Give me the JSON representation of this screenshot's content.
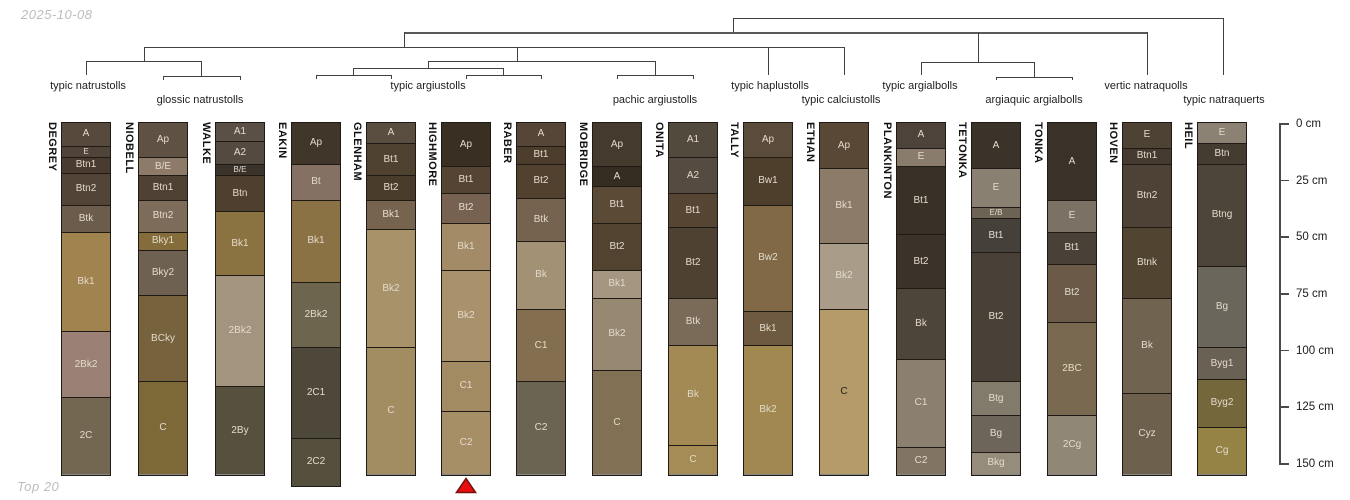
{
  "header": {
    "date_label": "2025-10-08"
  },
  "footer": {
    "label": "Top 20"
  },
  "style_colors": {
    "marker_fill": "#e90f0f",
    "marker_stroke": "#7a1010",
    "dendrogram_line": "#414141",
    "column_border": "#1f1a14"
  },
  "chart_data": {
    "type": "soil-profile-dendrogram",
    "depth_axis": {
      "unit": "cm",
      "tick_labels": [
        "0 cm",
        "25 cm",
        "50 cm",
        "75 cm",
        "100 cm",
        "125 cm",
        "150 cm"
      ],
      "tick_values": [
        0,
        25,
        50,
        75,
        100,
        125,
        150
      ]
    },
    "cluster_labels": [
      {
        "label": "typic natrustolls",
        "x": 88,
        "row": 1
      },
      {
        "label": "glossic natrustolls",
        "x": 200,
        "row": 2
      },
      {
        "label": "typic argiustolls",
        "x": 428,
        "row": 1
      },
      {
        "label": "pachic argiustolls",
        "x": 655,
        "row": 2
      },
      {
        "label": "typic haplustolls",
        "x": 770,
        "row": 1
      },
      {
        "label": "typic calciustolls",
        "x": 841,
        "row": 2
      },
      {
        "label": "typic argialbolls",
        "x": 920,
        "row": 1
      },
      {
        "label": "argiaquic argialbolls",
        "x": 1034,
        "row": 2
      },
      {
        "label": "vertic natraquolls",
        "x": 1146,
        "row": 1
      },
      {
        "label": "typic natraquerts",
        "x": 1224,
        "row": 2
      }
    ],
    "profiles": [
      {
        "name": "DEGREY",
        "cx": 86,
        "marker": false,
        "horizons": [
          {
            "label": "A",
            "top": 0,
            "bottom": 10,
            "color": "#57493c"
          },
          {
            "label": "E",
            "top": 10,
            "bottom": 15,
            "color": "#4f433a"
          },
          {
            "label": "Btn1",
            "top": 15,
            "bottom": 22,
            "color": "#493b2f"
          },
          {
            "label": "Btn2",
            "top": 22,
            "bottom": 36,
            "color": "#524437"
          },
          {
            "label": "Btk",
            "top": 36,
            "bottom": 48,
            "color": "#6c5c4b"
          },
          {
            "label": "Bk1",
            "top": 48,
            "bottom": 92,
            "color": "#a0834e"
          },
          {
            "label": "2Bk2",
            "top": 92,
            "bottom": 121,
            "color": "#9b8175"
          },
          {
            "label": "2C",
            "top": 121,
            "bottom": 155,
            "color": "#746751"
          }
        ]
      },
      {
        "name": "NIOBELL",
        "cx": 163,
        "marker": false,
        "horizons": [
          {
            "label": "Ap",
            "top": 0,
            "bottom": 15,
            "color": "#5f5143"
          },
          {
            "label": "B/E",
            "top": 15,
            "bottom": 23,
            "color": "#8d7a69"
          },
          {
            "label": "Btn1",
            "top": 23,
            "bottom": 34,
            "color": "#4f4134"
          },
          {
            "label": "Btn2",
            "top": 34,
            "bottom": 48,
            "color": "#7e6c5b"
          },
          {
            "label": "Bky1",
            "top": 48,
            "bottom": 56,
            "color": "#856d3b"
          },
          {
            "label": "Bky2",
            "top": 56,
            "bottom": 76,
            "color": "#6e6152"
          },
          {
            "label": "BCky",
            "top": 76,
            "bottom": 114,
            "color": "#76623c"
          },
          {
            "label": "C",
            "top": 114,
            "bottom": 155,
            "color": "#7d6838"
          }
        ]
      },
      {
        "name": "WALKE",
        "cx": 240,
        "marker": false,
        "horizons": [
          {
            "label": "A1",
            "top": 0,
            "bottom": 8,
            "color": "#5a5045"
          },
          {
            "label": "A2",
            "top": 8,
            "bottom": 18,
            "color": "#554a3f"
          },
          {
            "label": "B/E",
            "top": 18,
            "bottom": 23,
            "color": "#3a332b"
          },
          {
            "label": "Btn",
            "top": 23,
            "bottom": 39,
            "color": "#4e3f2e"
          },
          {
            "label": "Bk1",
            "top": 39,
            "bottom": 67,
            "color": "#8a7340"
          },
          {
            "label": "2Bk2",
            "top": 67,
            "bottom": 116,
            "color": "#a39480"
          },
          {
            "label": "2By",
            "top": 116,
            "bottom": 155,
            "color": "#56503f"
          }
        ]
      },
      {
        "name": "EAKIN",
        "cx": 316,
        "marker": false,
        "horizons": [
          {
            "label": "Ap",
            "top": 0,
            "bottom": 18,
            "color": "#41362a"
          },
          {
            "label": "Bt",
            "top": 18,
            "bottom": 34,
            "color": "#857163"
          },
          {
            "label": "Bk1",
            "top": 34,
            "bottom": 70,
            "color": "#8b7244"
          },
          {
            "label": "2Bk2",
            "top": 70,
            "bottom": 99,
            "color": "#6e654f"
          },
          {
            "label": "2C1",
            "top": 99,
            "bottom": 139,
            "color": "#4d483a"
          },
          {
            "label": "2C2",
            "top": 139,
            "bottom": 160,
            "color": "#55503e"
          }
        ]
      },
      {
        "name": "GLENHAM",
        "cx": 391,
        "marker": false,
        "horizons": [
          {
            "label": "A",
            "top": 0,
            "bottom": 9,
            "color": "#5a4e41"
          },
          {
            "label": "Bt1",
            "top": 9,
            "bottom": 23,
            "color": "#504231"
          },
          {
            "label": "Bt2",
            "top": 23,
            "bottom": 34,
            "color": "#4a3c2b"
          },
          {
            "label": "Bk1",
            "top": 34,
            "bottom": 47,
            "color": "#76644e"
          },
          {
            "label": "Bk2",
            "top": 47,
            "bottom": 99,
            "color": "#a8926a"
          },
          {
            "label": "C",
            "top": 99,
            "bottom": 155,
            "color": "#a28c62"
          }
        ]
      },
      {
        "name": "HIGHMORE",
        "cx": 466,
        "marker": true,
        "horizons": [
          {
            "label": "Ap",
            "top": 0,
            "bottom": 19,
            "color": "#392f23"
          },
          {
            "label": "Bt1",
            "top": 19,
            "bottom": 31,
            "color": "#554434"
          },
          {
            "label": "Bt2",
            "top": 31,
            "bottom": 44,
            "color": "#776150"
          },
          {
            "label": "Bk1",
            "top": 44,
            "bottom": 65,
            "color": "#a28b66"
          },
          {
            "label": "Bk2",
            "top": 65,
            "bottom": 105,
            "color": "#a9916b"
          },
          {
            "label": "C1",
            "top": 105,
            "bottom": 127,
            "color": "#a28a62"
          },
          {
            "label": "C2",
            "top": 127,
            "bottom": 155,
            "color": "#a68e66"
          }
        ]
      },
      {
        "name": "RABER",
        "cx": 541,
        "marker": false,
        "horizons": [
          {
            "label": "A",
            "top": 0,
            "bottom": 10,
            "color": "#554638"
          },
          {
            "label": "Bt1",
            "top": 10,
            "bottom": 18,
            "color": "#4d3d2c"
          },
          {
            "label": "Bt2",
            "top": 18,
            "bottom": 33,
            "color": "#52412e"
          },
          {
            "label": "Btk",
            "top": 33,
            "bottom": 52,
            "color": "#76634f"
          },
          {
            "label": "Bk",
            "top": 52,
            "bottom": 82,
            "color": "#a29175"
          },
          {
            "label": "C1",
            "top": 82,
            "bottom": 114,
            "color": "#836f4f"
          },
          {
            "label": "C2",
            "top": 114,
            "bottom": 155,
            "color": "#6c6452"
          }
        ]
      },
      {
        "name": "MOBRIDGE",
        "cx": 617,
        "marker": false,
        "horizons": [
          {
            "label": "Ap",
            "top": 0,
            "bottom": 19,
            "color": "#443a2e"
          },
          {
            "label": "A",
            "top": 19,
            "bottom": 28,
            "color": "#352c22"
          },
          {
            "label": "Bt1",
            "top": 28,
            "bottom": 44,
            "color": "#5b4a36"
          },
          {
            "label": "Bt2",
            "top": 44,
            "bottom": 65,
            "color": "#524230"
          },
          {
            "label": "Bk1",
            "top": 65,
            "bottom": 77,
            "color": "#a49680"
          },
          {
            "label": "Bk2",
            "top": 77,
            "bottom": 109,
            "color": "#978971"
          },
          {
            "label": "C",
            "top": 109,
            "bottom": 155,
            "color": "#827054"
          }
        ]
      },
      {
        "name": "ONITA",
        "cx": 693,
        "marker": false,
        "horizons": [
          {
            "label": "A1",
            "top": 0,
            "bottom": 15,
            "color": "#534a3e"
          },
          {
            "label": "A2",
            "top": 15,
            "bottom": 31,
            "color": "#564b40"
          },
          {
            "label": "Bt1",
            "top": 31,
            "bottom": 46,
            "color": "#564533"
          },
          {
            "label": "Bt2",
            "top": 46,
            "bottom": 77,
            "color": "#4e4132"
          },
          {
            "label": "Btk",
            "top": 77,
            "bottom": 98,
            "color": "#7a6b58"
          },
          {
            "label": "Bk",
            "top": 98,
            "bottom": 142,
            "color": "#a38a54"
          },
          {
            "label": "C",
            "top": 142,
            "bottom": 155,
            "color": "#a58c56"
          }
        ]
      },
      {
        "name": "TALLY",
        "cx": 768,
        "marker": false,
        "horizons": [
          {
            "label": "Ap",
            "top": 0,
            "bottom": 15,
            "color": "#5a4b3b"
          },
          {
            "label": "Bw1",
            "top": 15,
            "bottom": 36,
            "color": "#4e3e2c"
          },
          {
            "label": "Bw2",
            "top": 36,
            "bottom": 83,
            "color": "#816947"
          },
          {
            "label": "Bk1",
            "top": 83,
            "bottom": 98,
            "color": "#6e5a40"
          },
          {
            "label": "Bk2",
            "top": 98,
            "bottom": 155,
            "color": "#a18850"
          }
        ]
      },
      {
        "name": "ETHAN",
        "cx": 844,
        "marker": false,
        "horizons": [
          {
            "label": "Ap",
            "top": 0,
            "bottom": 20,
            "color": "#594835"
          },
          {
            "label": "Bk1",
            "top": 20,
            "bottom": 53,
            "color": "#8c7b68"
          },
          {
            "label": "Bk2",
            "top": 53,
            "bottom": 82,
            "color": "#a99c89"
          },
          {
            "label": "C",
            "top": 82,
            "bottom": 155,
            "color": "#b49b69",
            "text_color": "#26201a"
          }
        ]
      },
      {
        "name": "PLANKINTON",
        "cx": 921,
        "marker": false,
        "horizons": [
          {
            "label": "A",
            "top": 0,
            "bottom": 11,
            "color": "#4e433a"
          },
          {
            "label": "E",
            "top": 11,
            "bottom": 19,
            "color": "#897c6d"
          },
          {
            "label": "Bt1",
            "top": 19,
            "bottom": 49,
            "color": "#393028"
          },
          {
            "label": "Bt2",
            "top": 49,
            "bottom": 73,
            "color": "#3b322a"
          },
          {
            "label": "Bk",
            "top": 73,
            "bottom": 104,
            "color": "#4d443a"
          },
          {
            "label": "C1",
            "top": 104,
            "bottom": 143,
            "color": "#8b7f6f"
          },
          {
            "label": "C2",
            "top": 143,
            "bottom": 155,
            "color": "#827463"
          }
        ]
      },
      {
        "name": "TETONKA",
        "cx": 996,
        "marker": false,
        "horizons": [
          {
            "label": "A",
            "top": 0,
            "bottom": 20,
            "color": "#3b322a"
          },
          {
            "label": "E",
            "top": 20,
            "bottom": 37,
            "color": "#8a8071"
          },
          {
            "label": "E/B",
            "top": 37,
            "bottom": 42,
            "color": "#6c6355"
          },
          {
            "label": "Bt1",
            "top": 42,
            "bottom": 57,
            "color": "#46403a"
          },
          {
            "label": "Bt2",
            "top": 57,
            "bottom": 114,
            "color": "#494138"
          },
          {
            "label": "Btg",
            "top": 114,
            "bottom": 129,
            "color": "#827b6c"
          },
          {
            "label": "Bg",
            "top": 129,
            "bottom": 145,
            "color": "#6d655a"
          },
          {
            "label": "Bkg",
            "top": 145,
            "bottom": 155,
            "color": "#958c7b"
          }
        ]
      },
      {
        "name": "TONKA",
        "cx": 1072,
        "marker": false,
        "horizons": [
          {
            "label": "A",
            "top": 0,
            "bottom": 34,
            "color": "#3a3129"
          },
          {
            "label": "E",
            "top": 34,
            "bottom": 48,
            "color": "#7b7164"
          },
          {
            "label": "Bt1",
            "top": 48,
            "bottom": 62,
            "color": "#494037"
          },
          {
            "label": "Bt2",
            "top": 62,
            "bottom": 88,
            "color": "#6c5a49"
          },
          {
            "label": "2BC",
            "top": 88,
            "bottom": 129,
            "color": "#796950"
          },
          {
            "label": "2Cg",
            "top": 129,
            "bottom": 155,
            "color": "#908777"
          }
        ]
      },
      {
        "name": "HOVEN",
        "cx": 1147,
        "marker": false,
        "horizons": [
          {
            "label": "E",
            "top": 0,
            "bottom": 11,
            "color": "#4e4235"
          },
          {
            "label": "Btn1",
            "top": 11,
            "bottom": 18,
            "color": "#453a2f"
          },
          {
            "label": "Btn2",
            "top": 18,
            "bottom": 46,
            "color": "#4e4236"
          },
          {
            "label": "Btnk",
            "top": 46,
            "bottom": 77,
            "color": "#514431"
          },
          {
            "label": "Bk",
            "top": 77,
            "bottom": 119,
            "color": "#706350"
          },
          {
            "label": "Cyz",
            "top": 119,
            "bottom": 155,
            "color": "#6d614d"
          }
        ]
      },
      {
        "name": "HEIL",
        "cx": 1222,
        "marker": false,
        "horizons": [
          {
            "label": "E",
            "top": 0,
            "bottom": 9,
            "color": "#8c8273"
          },
          {
            "label": "Btn",
            "top": 9,
            "bottom": 18,
            "color": "#443b31"
          },
          {
            "label": "Btng",
            "top": 18,
            "bottom": 63,
            "color": "#4d4539"
          },
          {
            "label": "Bg",
            "top": 63,
            "bottom": 99,
            "color": "#6b665b"
          },
          {
            "label": "Byg1",
            "top": 99,
            "bottom": 113,
            "color": "#696153"
          },
          {
            "label": "Byg2",
            "top": 113,
            "bottom": 134,
            "color": "#74673b"
          },
          {
            "label": "Cg",
            "top": 134,
            "bottom": 155,
            "color": "#948344"
          }
        ]
      }
    ]
  }
}
